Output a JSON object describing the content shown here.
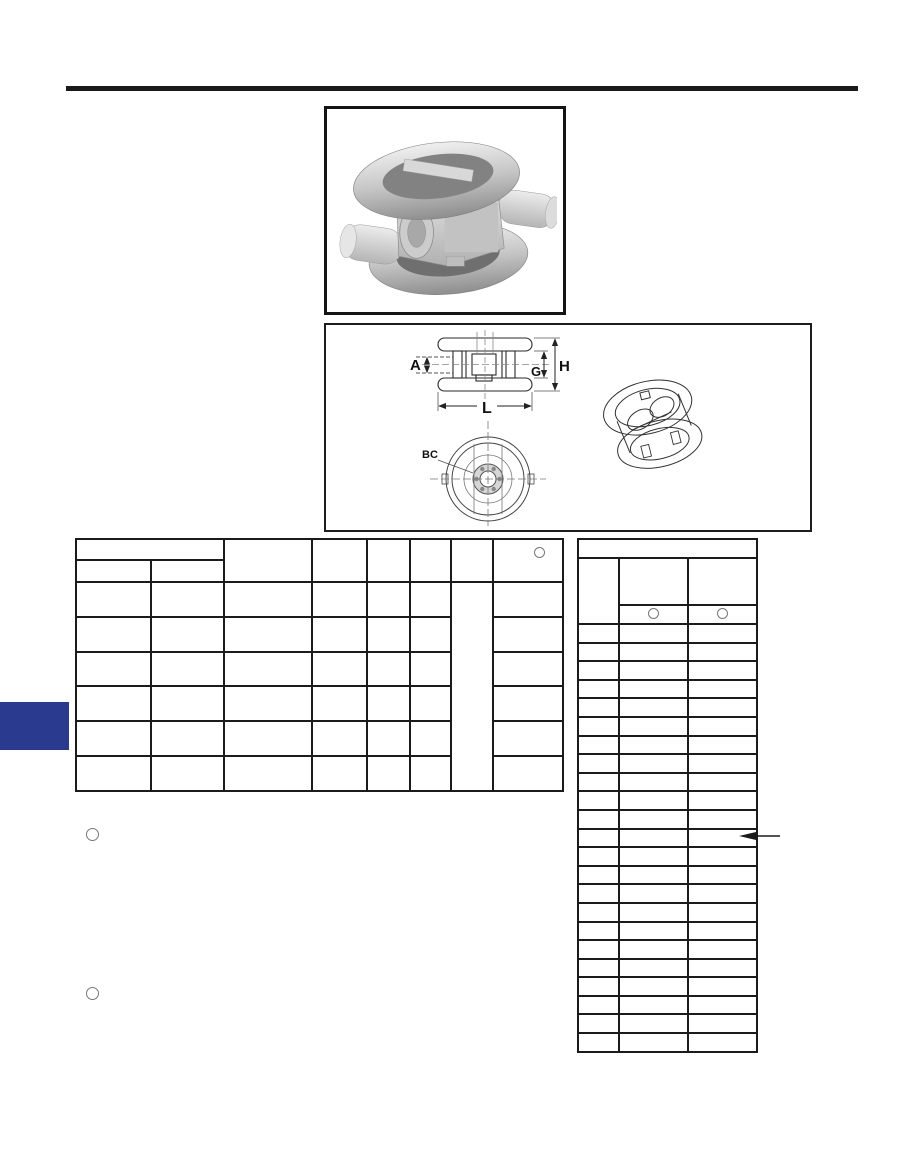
{
  "page": {
    "type": "product-catalog-scan",
    "background": "#ffffff",
    "rule_color": "#1a1a1a",
    "accent_blue": "#2a3a8f",
    "grid_line_color": "#1b1b1b"
  },
  "product_photo": {
    "description": "grayscale 3D rendering of a dual-ring wafer check valve with two pipe stubs"
  },
  "drawing": {
    "dim_labels": {
      "a": "A",
      "g": "G",
      "h": "H",
      "l": "L",
      "bc": "BC"
    }
  },
  "left_table": {
    "column_widths": [
      75,
      73,
      88,
      55,
      43,
      41,
      42,
      70
    ],
    "header": {
      "group_cell": "",
      "sub_cells": [
        "",
        ""
      ],
      "column_cells": [
        "",
        "",
        "",
        "",
        ""
      ],
      "note_marker": "circle-outline"
    },
    "data_row_count": 6,
    "merged_column_index": 6,
    "rows": [
      [
        "",
        "",
        "",
        "",
        "",
        "",
        "",
        ""
      ],
      [
        "",
        "",
        "",
        "",
        "",
        "",
        ""
      ],
      [
        "",
        "",
        "",
        "",
        "",
        "",
        ""
      ],
      [
        "",
        "",
        "",
        "",
        "",
        "",
        ""
      ],
      [
        "",
        "",
        "",
        "",
        "",
        "",
        ""
      ],
      [
        "",
        "",
        "",
        "",
        "",
        "",
        ""
      ]
    ]
  },
  "right_table": {
    "column_widths": [
      41,
      69,
      69
    ],
    "top_band": "",
    "header_cells": [
      "",
      "",
      ""
    ],
    "note_markers": [
      "circle-outline",
      "circle-outline"
    ],
    "data_row_count": 23,
    "pointer_arrow_row": 12,
    "rows": []
  },
  "footnotes": [
    {
      "marker": "circle-outline",
      "text": ""
    },
    {
      "marker": "circle-outline",
      "text": ""
    }
  ]
}
